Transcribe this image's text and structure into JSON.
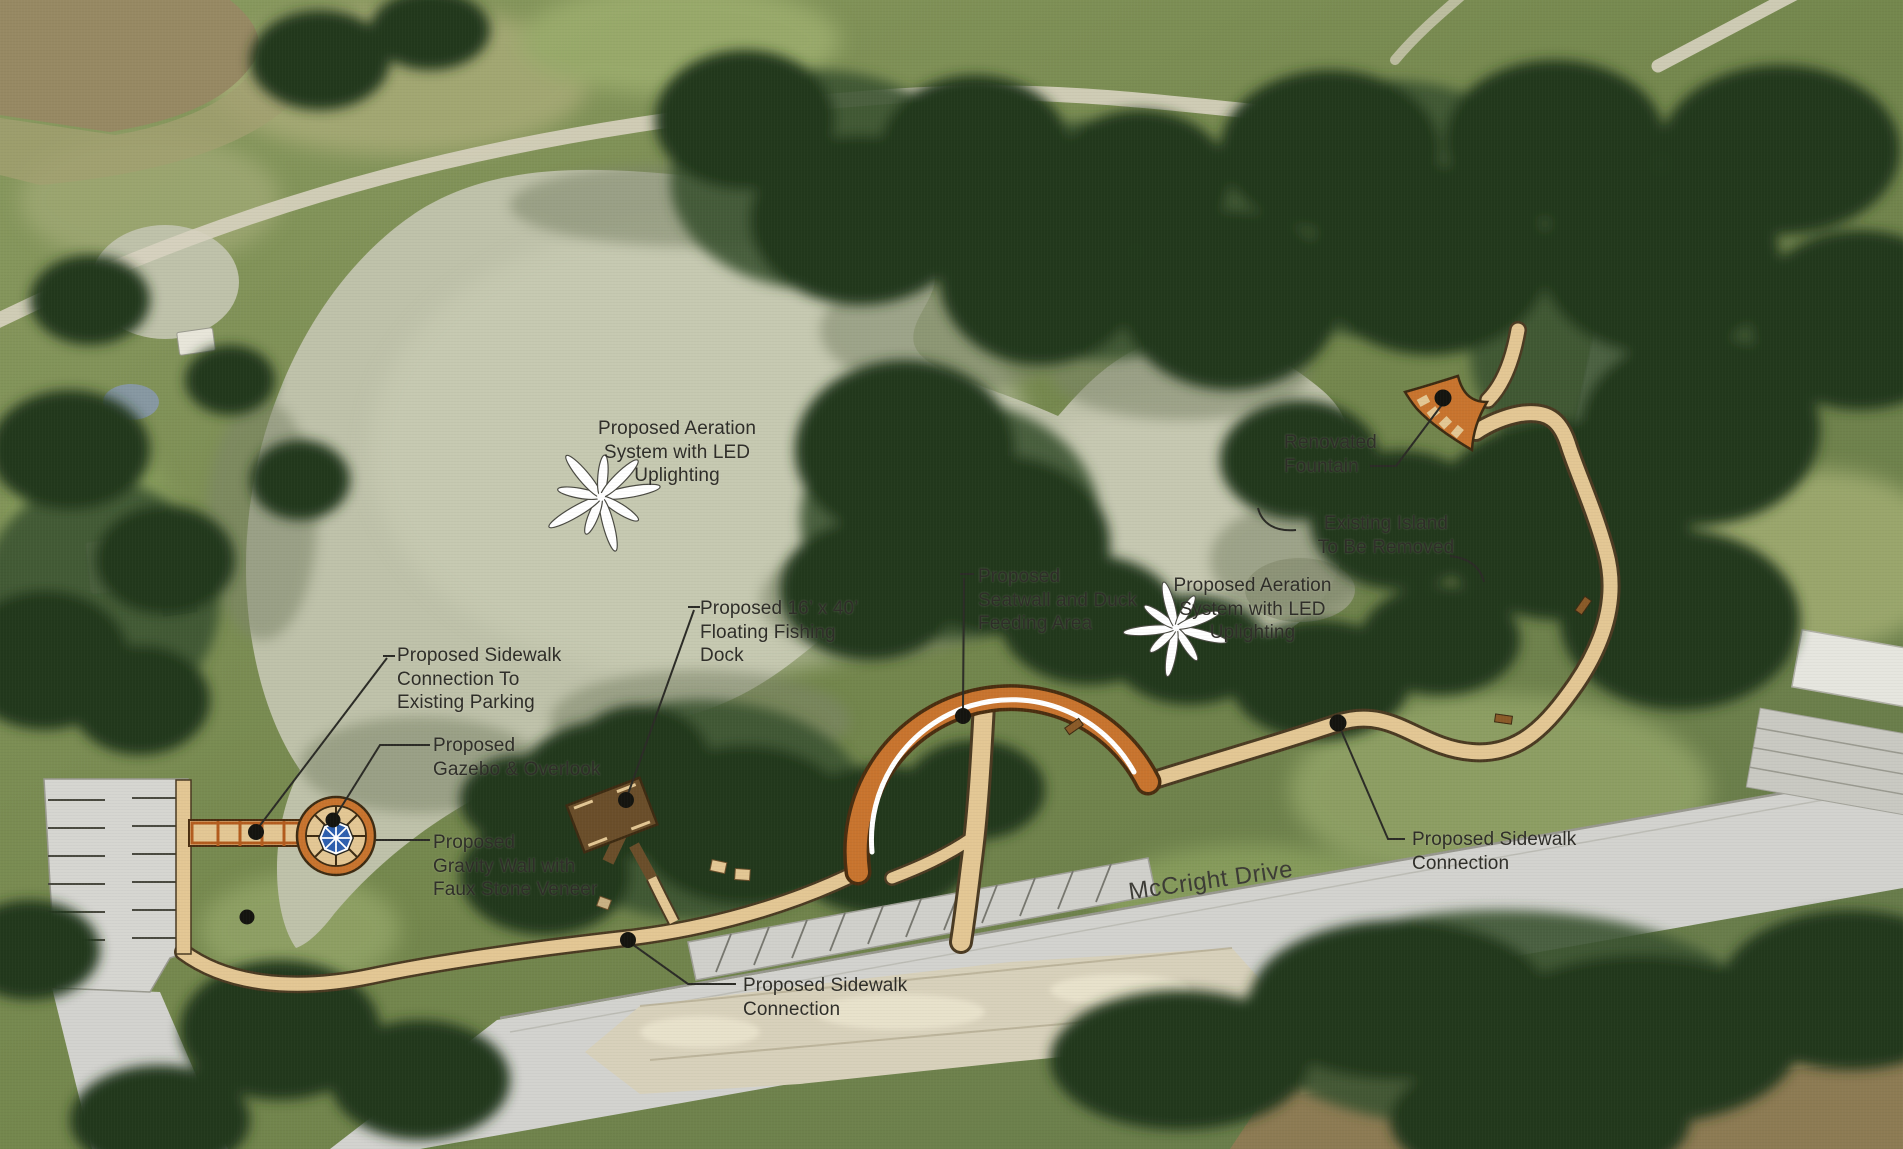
{
  "title": "Park Improvement Site Plan",
  "road": {
    "name": "McCright Drive"
  },
  "labels": [
    {
      "id": "aeration-west",
      "text": "Proposed Aeration\nSystem with LED\nUplighting"
    },
    {
      "id": "renovated-fountain",
      "text": "Renovated\nFountain"
    },
    {
      "id": "existing-island",
      "text": "Existing Island\nTo Be Removed"
    },
    {
      "id": "aeration-east",
      "text": "Proposed Aeration\nSystem with LED\nUplighting"
    },
    {
      "id": "seatwall-duck-area",
      "text": "Proposed\nSeatwall and Duck\nFeeding Area"
    },
    {
      "id": "floating-fishing-dock",
      "text": "Proposed 16’ x 40’\nFloating Fishing\nDock"
    },
    {
      "id": "sidewalk-to-parking",
      "text": "Proposed Sidewalk\nConnection To\nExisting Parking"
    },
    {
      "id": "gazebo-overlook",
      "text": "Proposed\nGazebo & Overlook"
    },
    {
      "id": "gravity-wall",
      "text": "Proposed\nGravity Wall with\nFaux Stone Veneer"
    },
    {
      "id": "sidewalk-connection-east",
      "text": "Proposed Sidewalk\nConnection"
    },
    {
      "id": "sidewalk-connection-south",
      "text": "Proposed Sidewalk\nConnection"
    }
  ],
  "icons": {
    "aeration_marker": "white-starburst-icon",
    "fountain_marker": "black-dot-marker",
    "leader_marker": "black-dot-marker",
    "gazebo_marker": "circular-overlook-with-blue-octagon-roof"
  },
  "colors": {
    "label": "#2e2d28",
    "pond": "#bfc2aa",
    "pond-light": "#cdcfb8",
    "grass": "#77894f",
    "grass-light": "#9dae6e",
    "tree-dark": "#24371f",
    "tree-mid": "#3a5430",
    "path-tan": "#e3c794",
    "path-edge": "#4a3a22",
    "orange": "#c8742e",
    "orange-dark": "#4a2e10",
    "road-gray": "#d3d3cf",
    "river-brown": "#8d7b53",
    "revetment": "#d8d1bb",
    "dock-brown": "#6a4e2a",
    "gazebo-blue": "#2d5fae",
    "starburst-white": "#ffffff"
  }
}
